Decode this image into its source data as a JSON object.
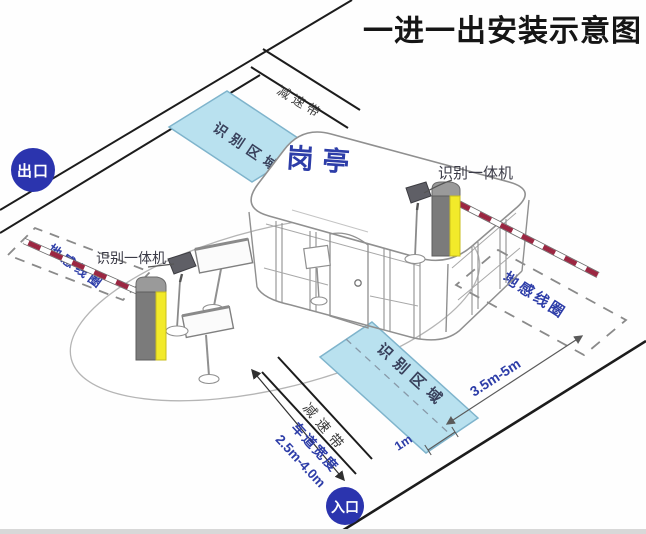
{
  "title": "一进一出安装示意图",
  "badges": {
    "exit": "出口",
    "entrance": "入口"
  },
  "booth": {
    "label": "岗亭"
  },
  "exit_lane": {
    "recognition_zone": "识别区域",
    "speed_bump": "减速带",
    "ground_loop": "地感线圈",
    "camera": "识别一体机"
  },
  "entrance_lane": {
    "recognition_zone": "识别区域",
    "speed_bump": "减速带",
    "ground_loop": "地感线圈",
    "camera": "识别一体机"
  },
  "dimensions": {
    "lane_width_label": "车道宽度",
    "lane_width_value": "2.5m-4.0m",
    "zone_to_gate_distance": "3.5m-5m",
    "zone_edge_offset": "1m"
  },
  "colors": {
    "accent_blue": "#2d3da8",
    "badge_blue": "#2b34ae",
    "zone_fill": "#b9e1ef",
    "zone_border": "#7fb4cc",
    "barrier_yellow": "#f2ea2a",
    "arm_stripe_red": "#9b2742",
    "label_dark": "#3b3b47",
    "line_black": "#1c1c1c"
  }
}
